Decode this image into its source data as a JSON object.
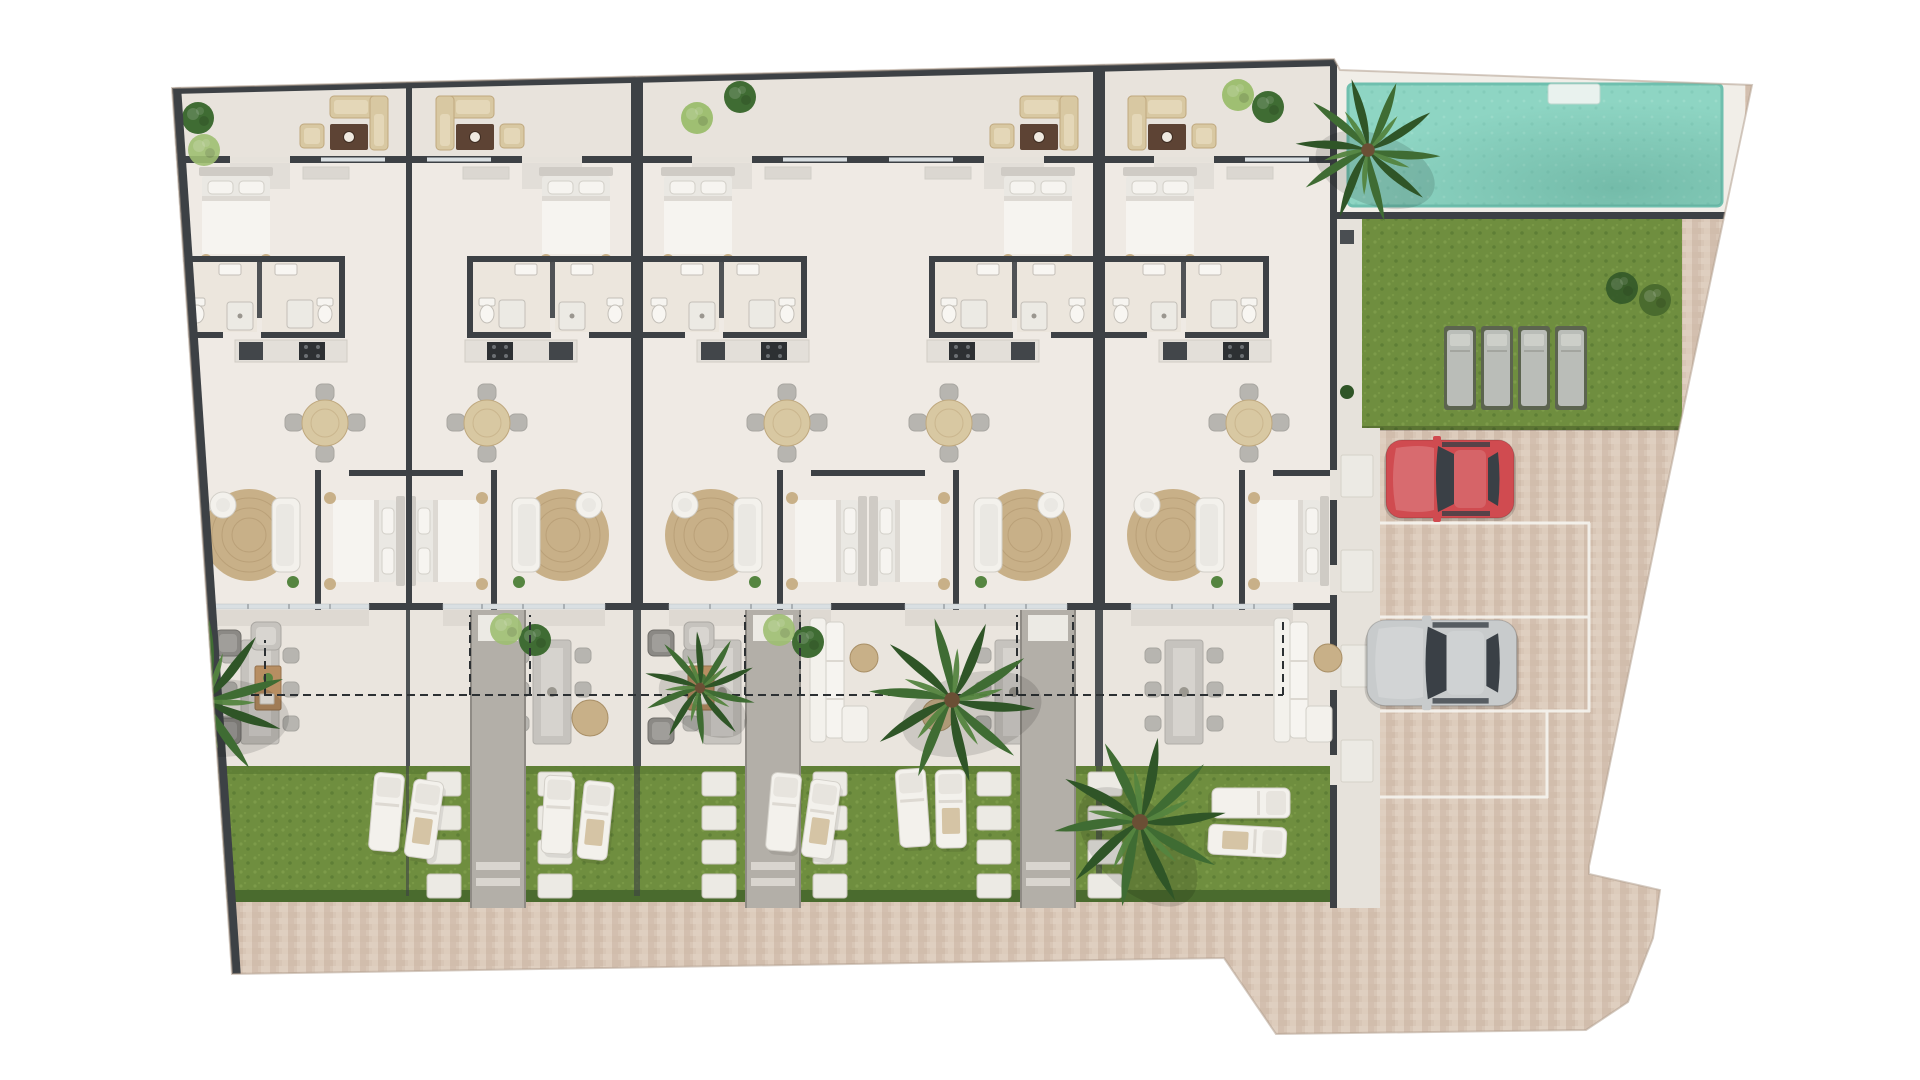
{
  "meta": {
    "description": "Top-down 3D architectural site plan render of five attached single-storey residences with front terraces, rear gardens, a communal swimming pool, lawn with sunbeds, and a paved parking court with two cars",
    "type": "floor-plan-render"
  },
  "colors": {
    "wall": "#3d4145",
    "floor": "#efeae4",
    "terrace_floor": "#e8e3dc",
    "rear_terrace_floor": "#eae5de",
    "bath_floor": "#ece6dd",
    "window": "#d9dfe2",
    "concrete": "#e6e2db",
    "stone_white": "#eceae4",
    "walkway": "#b3afa8",
    "grass": "#6f8e3f",
    "grass_light": "#83a14e",
    "grass_dark": "#5a7a33",
    "hedge": "#4a6b2e",
    "pool_deck": "#f1eee8",
    "pool_water": "#8ed5c3",
    "pool_water_deep": "#49917f",
    "paving": "#d8c6b6",
    "paving_dark": "#c9b2a0",
    "paving_light": "#e5d5c7",
    "furniture_white": "#f3f1ec",
    "furniture_outline": "#d2cfc8",
    "furniture_gray": "#c6c3be",
    "furniture_dark": "#8b8985",
    "chair_gray": "#b7b5b0",
    "tan": "#d8c8a2",
    "tan_dark": "#bfa87e",
    "brown": "#5d4334",
    "jute": "#c8b088",
    "jute_dark": "#a98f66",
    "linen": "#eae8e3",
    "linen_light": "#f6f4f0",
    "headboard": "#cfcbc5",
    "wood": "#b78e62",
    "car_red": "#d04b50",
    "car_silver": "#c8cbcc",
    "car_window": "#3a4046",
    "sunbed": "#babdb8",
    "sunbed_base": "#5c644f",
    "palm": "#3f6c33",
    "palm_dark": "#2f5527",
    "palm_light": "#558540",
    "bush_light": "#9fbf72",
    "dash": "#2c3033"
  },
  "site": {
    "residential_units": 5,
    "communal_amenities": [
      "swimming-pool",
      "lawn",
      "parking-court"
    ],
    "parking": {
      "bays": 4,
      "cars": [
        {
          "color": "red"
        },
        {
          "color": "silver"
        }
      ]
    },
    "pool_sunbeds": 4,
    "palm_trees": 5,
    "unit_features": [
      "front-terrace",
      "bedroom",
      "bathroom",
      "kitchen",
      "living-dining",
      "rear-terrace",
      "private-garden"
    ],
    "per_unit": {
      "beds": 2,
      "garden_sun_loungers": 2,
      "terrace_dining_seats": 6,
      "indoor_dining_seats": 4
    }
  }
}
